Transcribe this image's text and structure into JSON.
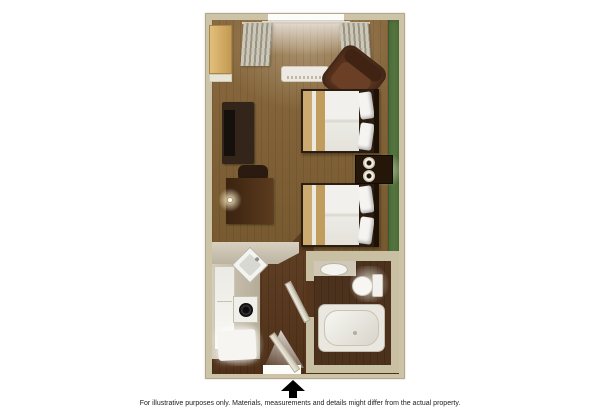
{
  "page": {
    "background": "#ffffff",
    "footer": {
      "disclaimer": "For illustrative purposes only.  Materials, measurements and details might differ from the actual property."
    }
  },
  "floorplan": {
    "type": "hotel-studio-room-floor-plan",
    "entrance_indicator": "up-arrow",
    "rooms": [
      {
        "name": "main-room",
        "floor": "carpet-brown",
        "features": [
          "window-with-curtains",
          "ac-unit",
          "armchair",
          "closet",
          "tv-cabinet",
          "desk",
          "desk-chair",
          "desk-lamp",
          "double-bed-1",
          "double-bed-2",
          "nightstand",
          "table-lamp-1",
          "table-lamp-2",
          "green-accent-wall"
        ]
      },
      {
        "name": "kitchenette",
        "floor": "dark-wood",
        "features": [
          "l-shaped-counter",
          "corner-sink",
          "stove",
          "refrigerator",
          "lit-cabinet"
        ]
      },
      {
        "name": "bathroom",
        "floor": "dark-wood",
        "features": [
          "vanity-sink",
          "toilet",
          "bathtub",
          "bathroom-door"
        ]
      }
    ],
    "doors": [
      "entrance-door-open",
      "bathroom-door-open"
    ],
    "colors": {
      "wall": "#cdc3a7",
      "wall_edge": "#b3a88b",
      "accent_wall_green": "#55763f",
      "carpet_brown": "#7e6038",
      "dark_wood": "#57381f",
      "furniture_dark_brown": "#34251a",
      "armchair_brown": "#57321e",
      "counter_greige": "#ccc4b2",
      "bedding_white": "#f1f0ec",
      "bed_accent_tan": "#cbab6f",
      "arrow_black": "#000000"
    }
  }
}
